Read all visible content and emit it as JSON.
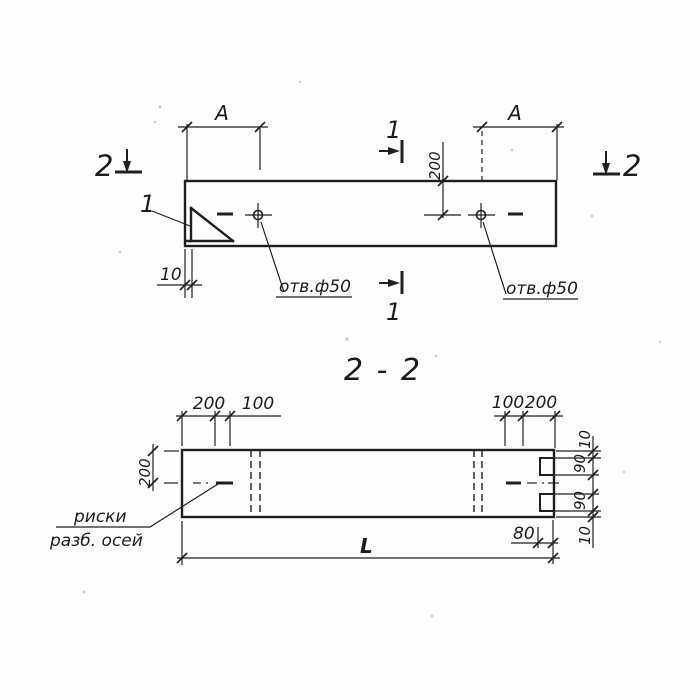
{
  "colors": {
    "ink": "#1f1f1f",
    "paper": "#fdfdfb"
  },
  "top_view": {
    "section_marker_left": "2",
    "section_marker_right": "2",
    "section_marker_1_top": "1",
    "section_marker_1_bottom": "1",
    "detail_callout": "1",
    "dim_a_left": "A",
    "dim_a_right": "A",
    "dim_top_edge_to_hole": "200",
    "dim_chamfer_offset": "10",
    "hole_label_left": "отв.ф50",
    "hole_label_right": "отв.ф50"
  },
  "section_view": {
    "title": "2 - 2",
    "dim_left_end": [
      "200",
      "100"
    ],
    "dim_right_end": [
      "100",
      "200"
    ],
    "dim_half_width": "200",
    "dim_right_chain": [
      "10",
      "90",
      "90",
      "10"
    ],
    "dim_notch_depth": "80",
    "dim_length": "L",
    "axis_note": [
      "риски",
      "разб. осей"
    ]
  }
}
